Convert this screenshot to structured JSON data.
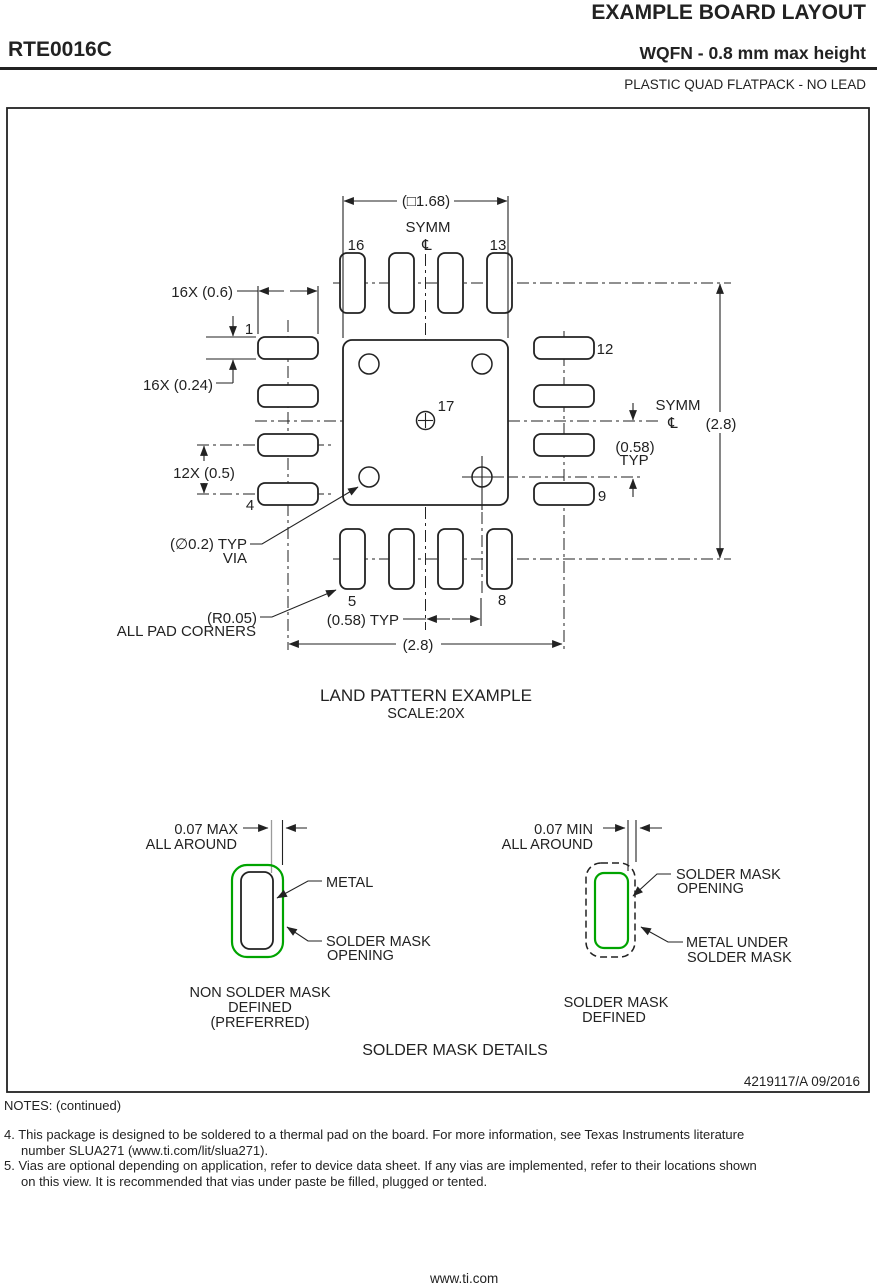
{
  "header": {
    "doc_title": "EXAMPLE BOARD LAYOUT",
    "part_number": "RTE0016C",
    "package_title": "WQFN - 0.8 mm max height",
    "package_subtitle": "PLASTIC QUAD FLATPACK - NO LEAD"
  },
  "drawing": {
    "land_pattern": {
      "dim_pad_grid": "(□1.68)",
      "symm_top": "SYMM",
      "symm_right": "SYMM",
      "centerline_symbol": "℄",
      "pins": {
        "p1": "1",
        "p4": "4",
        "p5": "5",
        "p8": "8",
        "p9": "9",
        "p12": "12",
        "p13": "13",
        "p16": "16",
        "p17": "17"
      },
      "dim_pad_width": "16X (0.6)",
      "dim_pad_height": "16X (0.24)",
      "dim_pitch": "12X (0.5)",
      "via_note_line1": "(∅0.2) TYP",
      "via_note_line2": "VIA",
      "corner_note_line1": "(R0.05)",
      "corner_note_line2": "ALL PAD CORNERS",
      "dim_058_bottom": "(0.58) TYP",
      "dim_058_right_line1": "(0.58)",
      "dim_058_right_line2": "TYP",
      "dim_28_bottom": "(2.8)",
      "dim_28_right": "(2.8)",
      "title": "LAND PATTERN EXAMPLE",
      "scale": "SCALE:20X"
    },
    "solder_mask": {
      "left": {
        "dim_line1": "0.07 MAX",
        "dim_line2": "ALL AROUND",
        "label_metal": "METAL",
        "label_opening_line1": "SOLDER MASK",
        "label_opening_line2": "OPENING",
        "caption_line1": "NON SOLDER MASK",
        "caption_line2": "DEFINED",
        "caption_line3": "(PREFERRED)"
      },
      "right": {
        "dim_line1": "0.07 MIN",
        "dim_line2": "ALL AROUND",
        "label_opening_line1": "SOLDER MASK",
        "label_opening_line2": "OPENING",
        "label_metal_line1": "METAL UNDER",
        "label_metal_line2": "SOLDER MASK",
        "caption_line1": "SOLDER MASK",
        "caption_line2": "DEFINED"
      },
      "section_title": "SOLDER MASK DETAILS"
    },
    "drawing_number": "4219117/A   09/2016"
  },
  "notes": {
    "heading": "NOTES: (continued)",
    "note4_line1": "4. This package is designed to be soldered to a thermal pad on the board. For more information, see Texas Instruments literature",
    "note4_line2": "number SLUA271 (www.ti.com/lit/slua271).",
    "note5_line1": "5. Vias are optional depending on application, refer to device data sheet. If any vias are implemented, refer to their locations shown",
    "note5_line2": "on this view. It is recommended that vias under paste be filled, plugged or tented."
  },
  "footer": {
    "url": "www.ti.com"
  },
  "colors": {
    "solder_mask_green": "#00A400",
    "ink": "#222222"
  }
}
